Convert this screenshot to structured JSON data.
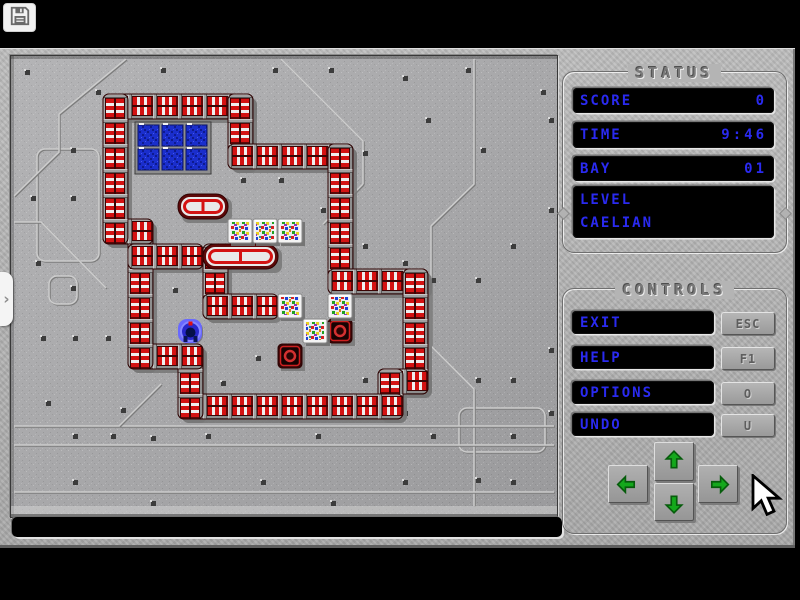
{
  "toolbar": {
    "save_tooltip": "save"
  },
  "status_panel": {
    "title": "STATUS",
    "rows": [
      {
        "label": "SCORE",
        "value": "0"
      },
      {
        "label": "TIME",
        "value": "9:46"
      },
      {
        "label": "BAY",
        "value": "01"
      }
    ],
    "level_label": "LEVEL",
    "level_value": "CAELIAN"
  },
  "controls_panel": {
    "title": "CONTROLS",
    "buttons": [
      {
        "label": "EXIT",
        "key": "ESC"
      },
      {
        "label": "HELP",
        "key": "F1"
      },
      {
        "label": "OPTIONS",
        "key": "O"
      },
      {
        "label": "UNDO",
        "key": "U"
      }
    ],
    "arrows": [
      "up",
      "left",
      "down",
      "right"
    ]
  },
  "message_bar": {
    "text": ""
  },
  "left_tab": {
    "glyph": "›"
  },
  "colors": {
    "text_blue": "#2a2af0",
    "pipe_red": "#d41212",
    "pipe_dark": "#5e0808",
    "pipe_white": "#efefef",
    "arrow_green": "#14a81c",
    "target_blue": "#1a2ecc",
    "metal_gray": "#b2b2b2",
    "board_gray": "#a8a8aa"
  },
  "board": {
    "grid": {
      "cell": 25,
      "origin": [
        67,
        13
      ]
    },
    "walls": [
      [
        1,
        1,
        6,
        1
      ],
      [
        6,
        1,
        6,
        3
      ],
      [
        6,
        3,
        10,
        3
      ],
      [
        10,
        3,
        10,
        8
      ],
      [
        10,
        8,
        13,
        8
      ],
      [
        13,
        8,
        13,
        12
      ],
      [
        12,
        12,
        13,
        12
      ],
      [
        12,
        12,
        12,
        13
      ],
      [
        4,
        13,
        12,
        13
      ],
      [
        4,
        11,
        4,
        13
      ],
      [
        2,
        11,
        4,
        11
      ],
      [
        2,
        6,
        2,
        11
      ],
      [
        1,
        6,
        2,
        6
      ],
      [
        1,
        1,
        1,
        6
      ],
      [
        2,
        7,
        4,
        7
      ],
      [
        5,
        7,
        5,
        9
      ],
      [
        5,
        9,
        7,
        9
      ]
    ],
    "stadiums": [
      [
        4,
        5,
        5,
        5
      ],
      [
        5,
        7,
        7,
        7
      ]
    ],
    "target_grid": {
      "x": 126,
      "y": 68,
      "cols": 3,
      "rows": 2,
      "cell": 24
    },
    "crates": [
      [
        6,
        6
      ],
      [
        7,
        6
      ],
      [
        8,
        6
      ],
      [
        8,
        9
      ],
      [
        10,
        9
      ],
      [
        9,
        10
      ]
    ],
    "sockets": [
      [
        10,
        10
      ],
      [
        8,
        11
      ]
    ],
    "player": [
      4,
      10
    ],
    "plates": [
      [
        26,
        93,
        62,
        112
      ],
      [
        448,
        352,
        86,
        44
      ],
      [
        38,
        220,
        28,
        28
      ]
    ],
    "etch_lines": [
      [
        [
          270,
          3
        ],
        [
          352,
          85
        ],
        [
          352,
          128
        ]
      ],
      [
        [
          352,
          128
        ],
        [
          312,
          168
        ]
      ],
      [
        [
          463,
          3
        ],
        [
          463,
          128
        ],
        [
          420,
          170
        ],
        [
          420,
          290
        ],
        [
          463,
          333
        ],
        [
          463,
          450
        ]
      ],
      [
        [
          3,
          140
        ],
        [
          48,
          96
        ],
        [
          48,
          58
        ]
      ],
      [
        [
          48,
          58
        ],
        [
          115,
          3
        ]
      ],
      [
        [
          3,
          166
        ],
        [
          30,
          166
        ],
        [
          95,
          232
        ]
      ],
      [
        [
          3,
          370
        ],
        [
          543,
          370
        ]
      ],
      [
        [
          3,
          389
        ],
        [
          543,
          389
        ]
      ],
      [
        [
          3,
          436
        ],
        [
          543,
          436
        ]
      ],
      [
        [
          108,
          370
        ],
        [
          150,
          328
        ]
      ]
    ],
    "rivets": [
      [
        14,
        14
      ],
      [
        85,
        34
      ],
      [
        150,
        12
      ],
      [
        262,
        12
      ],
      [
        318,
        12
      ],
      [
        392,
        20
      ],
      [
        455,
        12
      ],
      [
        530,
        34
      ],
      [
        60,
        92
      ],
      [
        20,
        140
      ],
      [
        60,
        140
      ],
      [
        95,
        168
      ],
      [
        25,
        205
      ],
      [
        60,
        230
      ],
      [
        135,
        188
      ],
      [
        162,
        232
      ],
      [
        230,
        122
      ],
      [
        268,
        122
      ],
      [
        310,
        152
      ],
      [
        352,
        95
      ],
      [
        415,
        62
      ],
      [
        470,
        92
      ],
      [
        538,
        62
      ],
      [
        352,
        188
      ],
      [
        392,
        205
      ],
      [
        420,
        222
      ],
      [
        465,
        222
      ],
      [
        500,
        188
      ],
      [
        538,
        152
      ],
      [
        30,
        280
      ],
      [
        62,
        280
      ],
      [
        95,
        280
      ],
      [
        110,
        352
      ],
      [
        35,
        345
      ],
      [
        62,
        378
      ],
      [
        100,
        378
      ],
      [
        140,
        380
      ],
      [
        195,
        378
      ],
      [
        250,
        355
      ],
      [
        305,
        378
      ],
      [
        352,
        322
      ],
      [
        392,
        355
      ],
      [
        465,
        322
      ],
      [
        500,
        322
      ],
      [
        538,
        292
      ],
      [
        420,
        378
      ],
      [
        465,
        422
      ],
      [
        500,
        378
      ],
      [
        538,
        355
      ],
      [
        62,
        424
      ],
      [
        140,
        445
      ],
      [
        250,
        424
      ],
      [
        320,
        445
      ],
      [
        392,
        424
      ],
      [
        500,
        424
      ],
      [
        245,
        300
      ],
      [
        210,
        325
      ]
    ]
  }
}
